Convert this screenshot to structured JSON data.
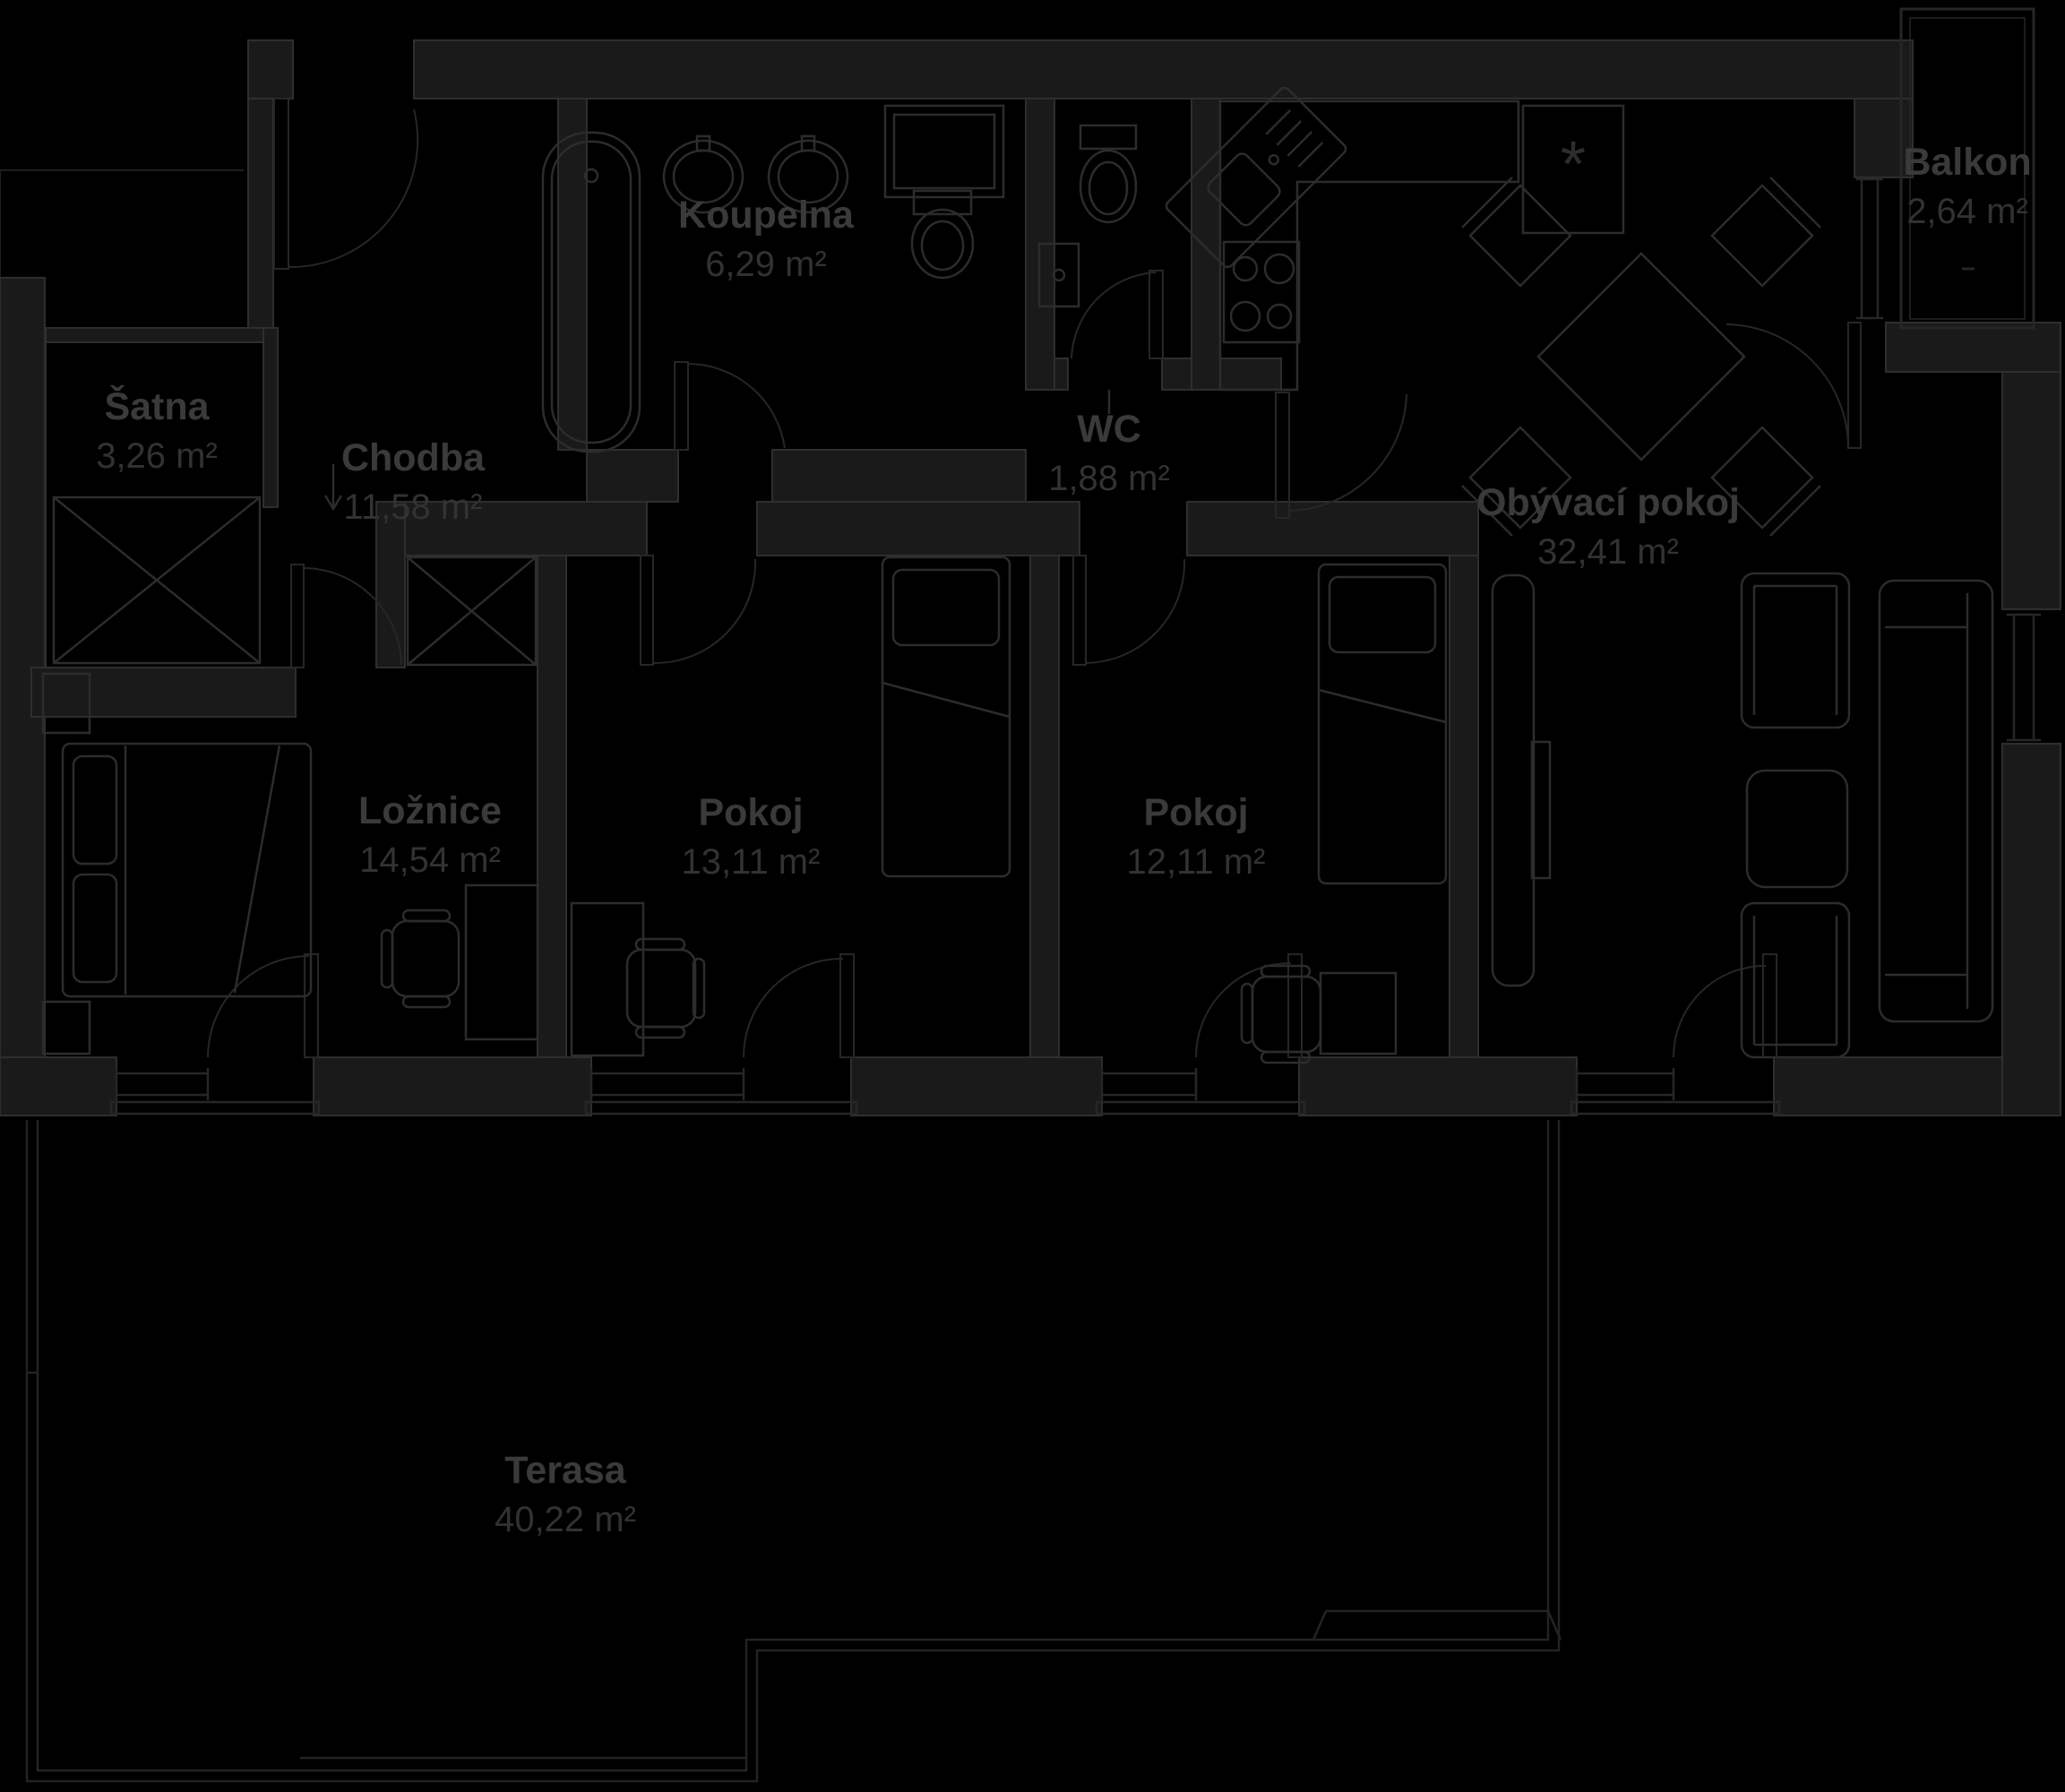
{
  "rooms": [
    {
      "id": "satna",
      "name": "Šatna",
      "area": "3,26 m²"
    },
    {
      "id": "chodba",
      "name": "Chodba",
      "area": "11,58 m²"
    },
    {
      "id": "koupelna",
      "name": "Koupelna",
      "area": "6,29 m²"
    },
    {
      "id": "wc",
      "name": "WC",
      "area": "1,88 m²"
    },
    {
      "id": "balkon",
      "name": "Balkon",
      "area": "2,64 m²"
    },
    {
      "id": "obyvaci-pokoj",
      "name": "Obývací pokoj",
      "area": "32,41 m²"
    },
    {
      "id": "loznice",
      "name": "Ložnice",
      "area": "14,54 m²"
    },
    {
      "id": "pokoj-1",
      "name": "Pokoj",
      "area": "13,11 m²"
    },
    {
      "id": "pokoj-2",
      "name": "Pokoj",
      "area": "12,11 m²"
    },
    {
      "id": "terasa",
      "name": "Terasa",
      "area": "40,22 m²"
    }
  ],
  "symbols": {
    "fridge": "*"
  },
  "colors": {
    "background": "#000000",
    "wall_fill": "#1a1a1a",
    "wall_stroke": "#2e2e2e",
    "furniture_line": "#2c2c2c",
    "door_line": "#262626",
    "window_line": "#262626",
    "terrace_line": "#232323",
    "label_name": "#3a3a3a",
    "label_area": "#323232"
  }
}
